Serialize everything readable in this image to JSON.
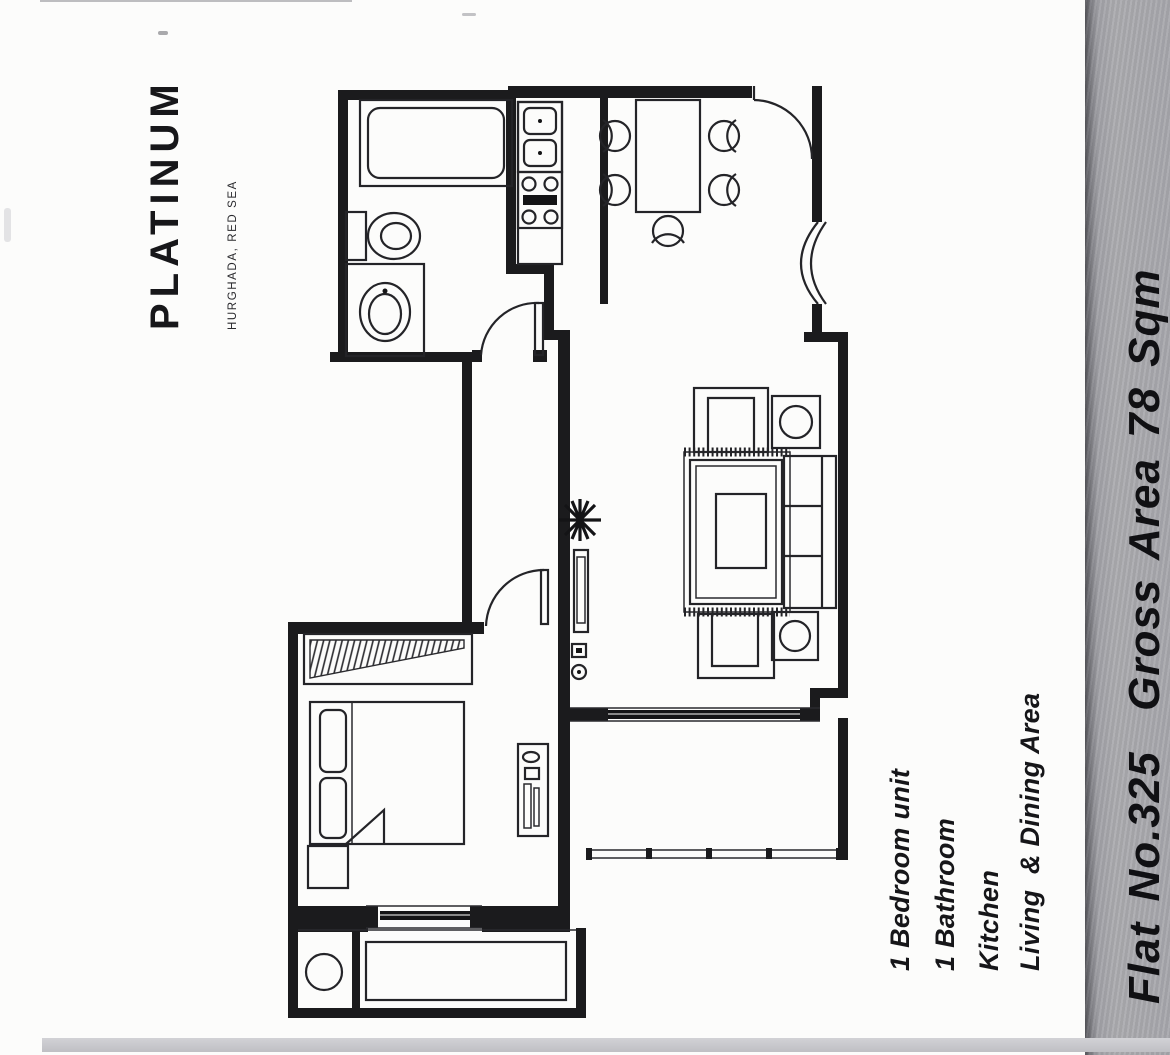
{
  "logo": {
    "brand": "PLATINUM",
    "location": "HURGHADA, RED SEA"
  },
  "flat_info": {
    "label": "Flat No.325  Gross Area 78 Sqm"
  },
  "features": {
    "items": [
      "1 Bedroom unit",
      "1 Bathroom",
      "Kitchen",
      "Living  & Dining Area"
    ]
  },
  "colors": {
    "side_bar": "#a7a7ac",
    "side_bar_edge": "#55555a",
    "bottom_bar": "#c6c6ca",
    "plan_line": "#1b1b1d",
    "page_background": "#fcfcfb",
    "text": "#141416"
  },
  "floorplan": {
    "type": "architectural-plan",
    "symbols": [
      "bathtub",
      "toilet",
      "washbasin",
      "kitchen-sink",
      "cooktop",
      "dining-table",
      "dining-chair",
      "entry-door",
      "arched-window",
      "interior-door",
      "armchair",
      "side-table",
      "coffee-table",
      "rug",
      "sofa",
      "potted-plant",
      "tv-console",
      "wardrobe-hatch",
      "double-bed",
      "pillow",
      "nightstand",
      "dresser",
      "window",
      "balcony-railing",
      "planter",
      "balcony-table"
    ]
  }
}
